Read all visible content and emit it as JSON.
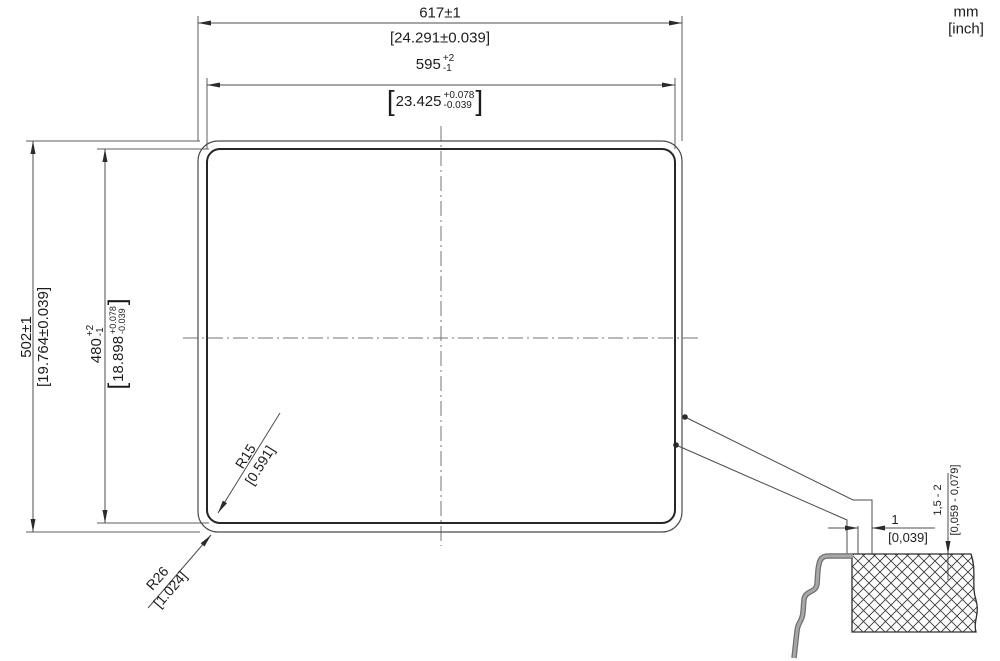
{
  "units": {
    "metric": "mm",
    "imperial_bracketed": "[inch]"
  },
  "symbols": {
    "lb": "[",
    "rb": "]"
  },
  "plan": {
    "outer_width": {
      "mm": "617±1",
      "inch": "[24.291±0.039]"
    },
    "cutout_width": {
      "mm": "595",
      "tol_plus": "+2",
      "tol_minus": "-1",
      "inch": "23.425",
      "inch_tol_plus": "+0.078",
      "inch_tol_minus": "-0.039"
    },
    "outer_height": {
      "mm": "502±1",
      "inch": "[19.764±0.039]"
    },
    "cutout_height": {
      "mm": "480",
      "tol_plus": "+2",
      "tol_minus": "-1",
      "inch": "18.898",
      "inch_tol_plus": "+0.078",
      "inch_tol_minus": "-0.039"
    },
    "corner_radius_inner": {
      "mm": "R15",
      "inch": "[0.591]"
    },
    "corner_radius_outer": {
      "mm": "R26",
      "inch": "[1.024]"
    }
  },
  "section": {
    "edge_gap": {
      "mm": "1",
      "inch": "[0,039]"
    },
    "panel_recess": {
      "mm": "1,5 - 2",
      "inch": "[0,059 - 0,079]"
    }
  }
}
